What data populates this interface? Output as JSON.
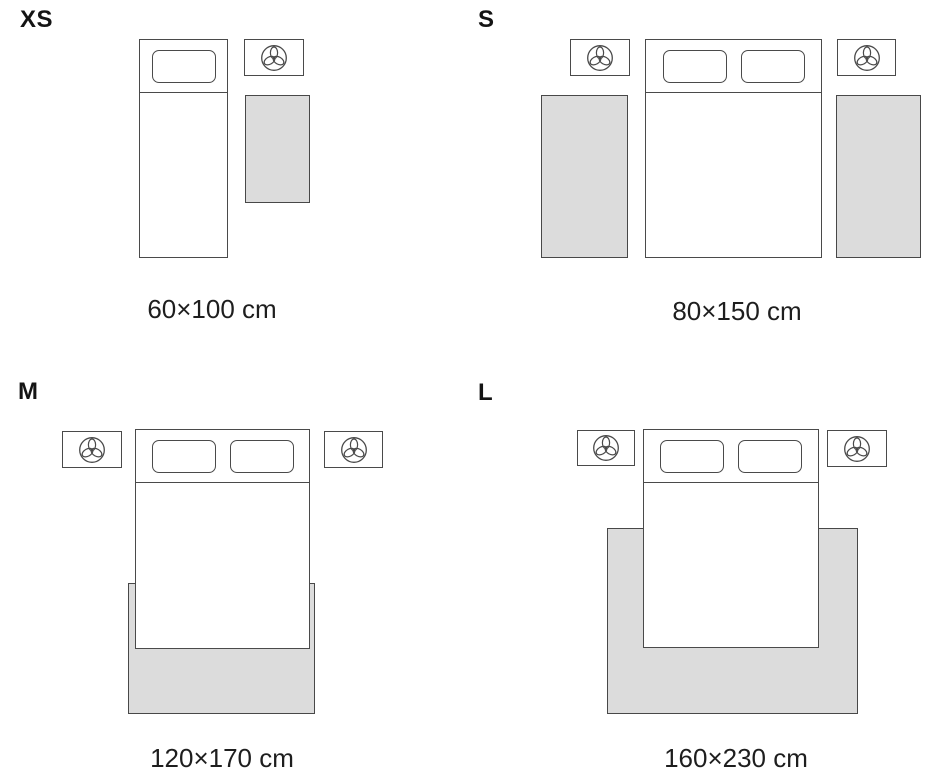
{
  "guide": {
    "sizes": [
      {
        "id": "xs",
        "label": "XS",
        "dimensions": "60×100 cm"
      },
      {
        "id": "s",
        "label": "S",
        "dimensions": "80×150 cm"
      },
      {
        "id": "m",
        "label": "M",
        "dimensions": "120×170 cm"
      },
      {
        "id": "l",
        "label": "L",
        "dimensions": "160×230 cm"
      }
    ],
    "icons": {
      "nightstand": "plant-top-view-icon"
    },
    "colors": {
      "outline": "#4a4a4a",
      "rug_fill": "#dcdcdc",
      "text": "#1e1e1e",
      "background": "#ffffff"
    }
  }
}
